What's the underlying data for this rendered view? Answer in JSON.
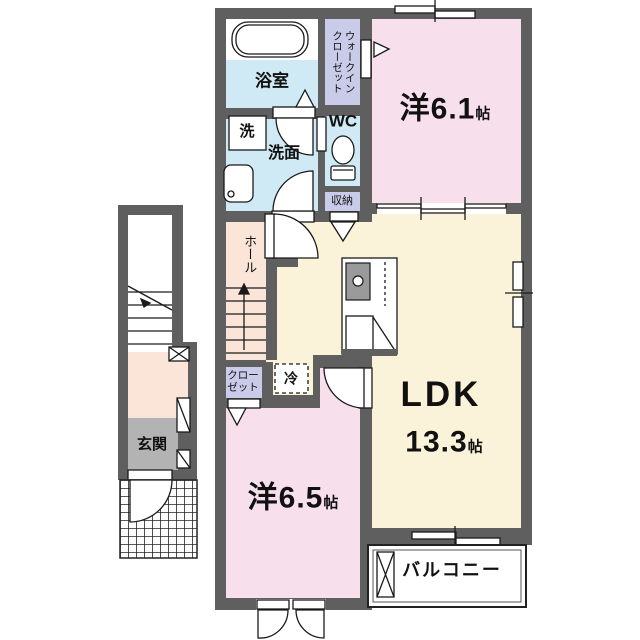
{
  "palette": {
    "wall": "#5f5f5f",
    "pink": "#f7dfec",
    "cream": "#faf3da",
    "blue": "#cfe9f5",
    "lavender": "#c9cbe9",
    "peach": "#fbe5d9",
    "grayfloor": "#b3b3b3",
    "line": "#1a1a1a",
    "white": "#ffffff"
  },
  "floorplan": {
    "rooms": {
      "bathroom": {
        "label": "浴室"
      },
      "walk_in_closet": {
        "label": "ウォークイン\nクローゼット"
      },
      "western_room_1": {
        "label": "洋6.1",
        "unit": "帖"
      },
      "laundry": {
        "label": "洗"
      },
      "washroom": {
        "label": "洗面"
      },
      "wc": {
        "label": "WC"
      },
      "storage": {
        "label": "収納"
      },
      "hall": {
        "label": "ホール"
      },
      "closet": {
        "label": "クロー\nゼット"
      },
      "refrigerator": {
        "label": "冷"
      },
      "ldk": {
        "label": "LDK",
        "size": "13.3",
        "unit": "帖"
      },
      "western_room_2": {
        "label": "洋6.5",
        "unit": "帖"
      },
      "entrance": {
        "label": "玄関"
      },
      "balcony": {
        "label": "バルコニー"
      }
    }
  }
}
